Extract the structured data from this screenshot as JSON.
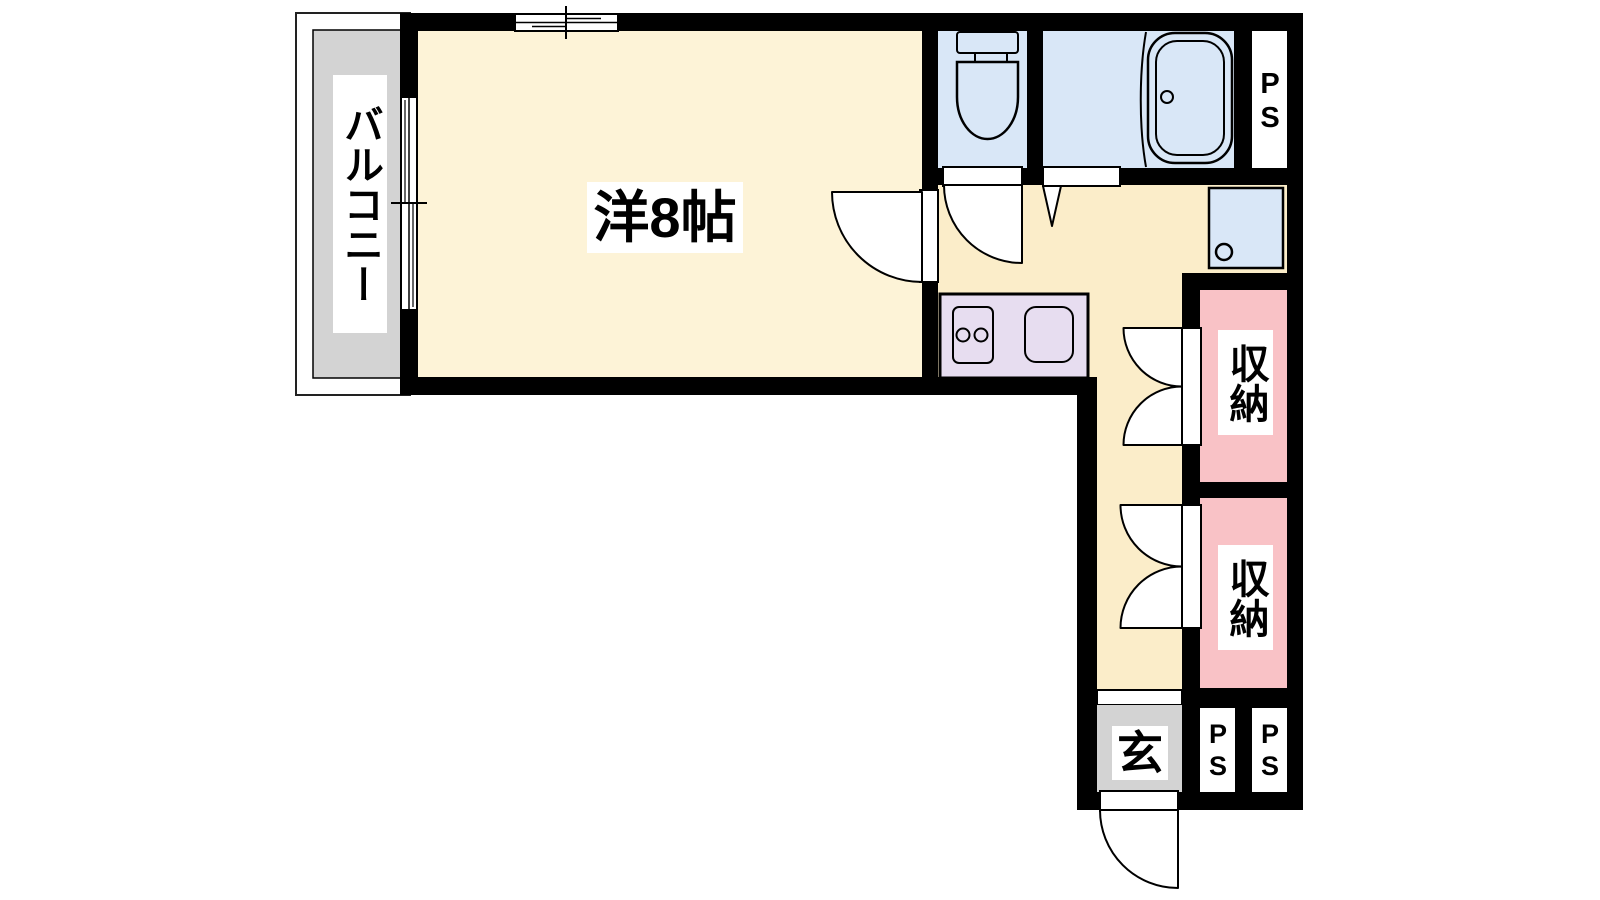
{
  "plan_title": "apartment floor plan",
  "colors": {
    "wall": "#000000",
    "room_fill": "#FDF3D7",
    "hall_fill": "#FBEDC9",
    "wet_area_fill": "#D9E7F7",
    "kitchen_fill": "#E7DDF0",
    "storage_fill": "#F9C2C6",
    "balcony_fill": "#D3D3D3",
    "entrance_fill": "#D3D3D3"
  },
  "rooms": {
    "balcony": {
      "label": "バルコニー"
    },
    "western_room": {
      "label": "洋8帖"
    },
    "storage_upper": {
      "label": "収納"
    },
    "storage_lower": {
      "label": "収納"
    },
    "entrance": {
      "label": "玄"
    },
    "ps_top": {
      "label": "PS"
    },
    "ps_bottom_left": {
      "label": "PS"
    },
    "ps_bottom_right": {
      "label": "PS"
    }
  },
  "fixtures": {
    "toilet": "toilet-icon",
    "bathtub": "bathtub-icon",
    "stove": "stove-burners-icon",
    "sink": "kitchen-sink-icon",
    "washer_pan": "washing-machine-pan-icon",
    "doors": "door-swing-icon",
    "windows": "sliding-window-icon"
  }
}
